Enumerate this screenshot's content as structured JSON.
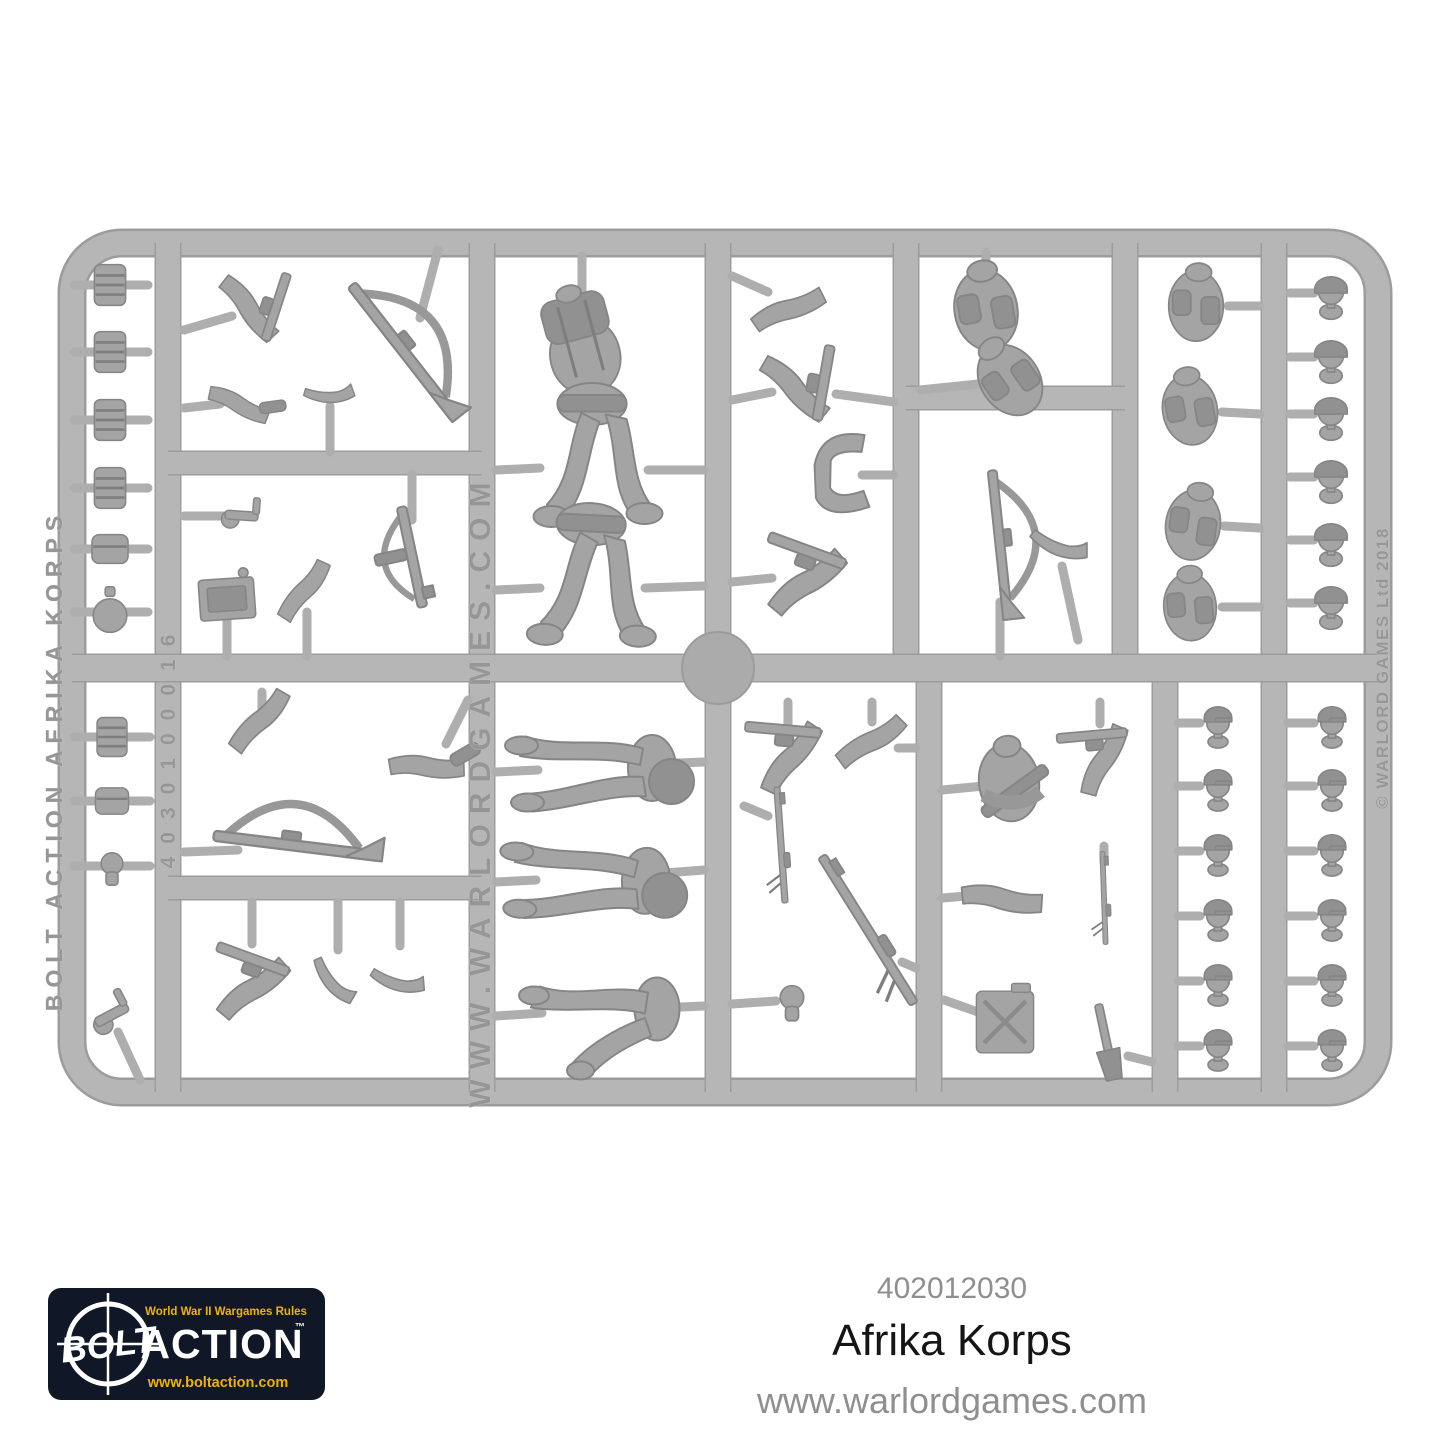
{
  "product": {
    "sku": "402012030",
    "name": "Afrika Korps",
    "website": "www.warlordgames.com"
  },
  "logo": {
    "tagline": "World War II Wargames Rules",
    "word_bolt": "BOLT",
    "word_action": "ACTION",
    "trademark": "™",
    "url": "www.boltaction.com",
    "bg_color": "#101827",
    "accent_color": "#f0b10d",
    "text_color": "#ffffff"
  },
  "sprue": {
    "plastic_color": "#b6b6b6",
    "edge_color": "#9c9c9c",
    "part_color": "#a4a4a4",
    "emboss_texts": {
      "left_rail": "BOLT ACTION AFRIKA KORPS",
      "mould_code": "4030100016",
      "center_rail": "WWW.WARLORDGAMES.COM",
      "right_rail": "© WARLORD GAMES Ltd 2018"
    },
    "parts": [
      {
        "k": "cyl",
        "x": 110,
        "y": 285,
        "s": 1.2,
        "stubs": [
          [
            74,
            285,
            148,
            285
          ]
        ]
      },
      {
        "k": "cyl",
        "x": 110,
        "y": 352,
        "s": 1.2,
        "stubs": [
          [
            74,
            352,
            148,
            352
          ]
        ]
      },
      {
        "k": "cyl",
        "x": 110,
        "y": 420,
        "s": 1.2,
        "stubs": [
          [
            74,
            420,
            148,
            420
          ]
        ]
      },
      {
        "k": "cyl",
        "x": 110,
        "y": 488,
        "s": 1.2,
        "stubs": [
          [
            74,
            488,
            148,
            488
          ]
        ]
      },
      {
        "k": "pouch",
        "x": 110,
        "y": 549,
        "s": 1.2,
        "stubs": [
          [
            74,
            549,
            148,
            549
          ]
        ]
      },
      {
        "k": "canteen",
        "x": 110,
        "y": 612,
        "s": 1.2,
        "stubs": [
          [
            74,
            612,
            148,
            612
          ]
        ]
      },
      {
        "k": "cyl",
        "x": 112,
        "y": 737,
        "s": 1.15,
        "stubs": [
          [
            74,
            737,
            150,
            737
          ]
        ]
      },
      {
        "k": "pouch",
        "x": 112,
        "y": 801,
        "s": 1.1,
        "stubs": [
          [
            74,
            801,
            150,
            801
          ]
        ]
      },
      {
        "k": "fist",
        "x": 112,
        "y": 866,
        "s": 1.2,
        "stubs": [
          [
            74,
            866,
            150,
            866
          ]
        ]
      },
      {
        "k": "pistolhand",
        "x": 117,
        "y": 1012,
        "r": -28,
        "s": 1.2,
        "stubs": [
          [
            118,
            1032,
            140,
            1080
          ]
        ]
      },
      {
        "k": "armgun",
        "x": 255,
        "y": 307,
        "r": 18,
        "s": 1.3,
        "stubs": [
          [
            184,
            330,
            232,
            316
          ]
        ]
      },
      {
        "k": "armtool",
        "x": 243,
        "y": 401,
        "r": -8,
        "s": 1.1,
        "stubs": [
          [
            184,
            408,
            220,
            404
          ]
        ]
      },
      {
        "k": "boot",
        "x": 330,
        "y": 389,
        "r": -35,
        "s": 1.1,
        "stubs": [
          [
            330,
            406,
            330,
            452
          ]
        ]
      },
      {
        "k": "riflesling",
        "x": 404,
        "y": 352,
        "r": 52,
        "s": 1.7,
        "stubs": [
          [
            438,
            250,
            420,
            318
          ]
        ]
      },
      {
        "k": "pistolhand",
        "x": 247,
        "y": 516,
        "r": 4,
        "s": 1.1,
        "stubs": [
          [
            184,
            516,
            226,
            516
          ]
        ]
      },
      {
        "k": "plate",
        "x": 227,
        "y": 599,
        "r": -4,
        "s": 1.2,
        "stubs": [
          [
            227,
            618,
            227,
            656
          ]
        ]
      },
      {
        "k": "arm",
        "x": 307,
        "y": 596,
        "r": 95,
        "s": 1.2,
        "stubs": [
          [
            307,
            612,
            307,
            656
          ]
        ]
      },
      {
        "k": "smg",
        "x": 412,
        "y": 557,
        "r": 78,
        "s": 1.6,
        "stubs": [
          [
            412,
            474,
            412,
            520
          ]
        ]
      },
      {
        "k": "torsopack",
        "x": 582,
        "y": 344,
        "r": -15,
        "s": 1.4,
        "stubs": [
          [
            582,
            256,
            582,
            300
          ]
        ]
      },
      {
        "k": "legsrun",
        "x": 592,
        "y": 464,
        "r": 0,
        "s": 1.5,
        "stubs": [
          [
            496,
            470,
            540,
            468
          ],
          [
            648,
            470,
            704,
            470
          ]
        ]
      },
      {
        "k": "legsrun",
        "x": 588,
        "y": 584,
        "r": 3,
        "s": 1.5,
        "stubs": [
          [
            496,
            590,
            540,
            588
          ],
          [
            645,
            588,
            704,
            586
          ]
        ]
      },
      {
        "k": "arm",
        "x": 789,
        "y": 303,
        "r": -55,
        "s": 1.3,
        "stubs": [
          [
            732,
            276,
            768,
            292
          ]
        ]
      },
      {
        "k": "armgun",
        "x": 801,
        "y": 386,
        "r": 10,
        "s": 1.4,
        "stubs": [
          [
            732,
            400,
            772,
            392
          ],
          [
            836,
            394,
            894,
            402
          ]
        ]
      },
      {
        "k": "armpair",
        "x": 838,
        "y": 475,
        "r": 85,
        "s": 1.5,
        "stubs": [
          [
            862,
            475,
            894,
            475
          ]
        ]
      },
      {
        "k": "armgun",
        "x": 806,
        "y": 575,
        "r": -70,
        "s": 1.5,
        "stubs": [
          [
            732,
            582,
            772,
            578
          ]
        ]
      },
      {
        "k": "torsogear",
        "x": 986,
        "y": 310,
        "r": -10,
        "s": 1.5,
        "stubs": [
          [
            986,
            252,
            986,
            280
          ]
        ]
      },
      {
        "k": "torsogear",
        "x": 1010,
        "y": 380,
        "r": -35,
        "s": 1.4,
        "stubs": [
          [
            920,
            390,
            978,
            384
          ]
        ]
      },
      {
        "k": "riflesling",
        "x": 1000,
        "y": 545,
        "r": 84,
        "s": 1.5,
        "stubs": [
          [
            1000,
            602,
            1000,
            656
          ]
        ]
      },
      {
        "k": "boot",
        "x": 1062,
        "y": 540,
        "r": -15,
        "s": 1.3,
        "stubs": [
          [
            1062,
            566,
            1078,
            640
          ]
        ]
      },
      {
        "k": "torsogear",
        "x": 1196,
        "y": 306,
        "r": 0,
        "s": 1.3,
        "stubs": [
          [
            1228,
            306,
            1260,
            306
          ]
        ]
      },
      {
        "k": "torsogear",
        "x": 1190,
        "y": 410,
        "r": -10,
        "s": 1.3,
        "stubs": [
          [
            1222,
            412,
            1260,
            414
          ]
        ]
      },
      {
        "k": "torsogear",
        "x": 1193,
        "y": 525,
        "r": 8,
        "s": 1.3,
        "stubs": [
          [
            1224,
            526,
            1260,
            528
          ]
        ]
      },
      {
        "k": "torsogear",
        "x": 1190,
        "y": 607,
        "r": -5,
        "s": 1.25,
        "stubs": [
          [
            1222,
            607,
            1260,
            607
          ]
        ]
      },
      {
        "k": "head",
        "x": 1331,
        "y": 293,
        "s": 1.25,
        "stubs": [
          [
            1290,
            293,
            1314,
            293
          ]
        ]
      },
      {
        "k": "head",
        "x": 1331,
        "y": 357,
        "s": 1.25,
        "stubs": [
          [
            1290,
            357,
            1314,
            357
          ]
        ]
      },
      {
        "k": "head",
        "x": 1331,
        "y": 414,
        "s": 1.25,
        "stubs": [
          [
            1290,
            414,
            1314,
            414
          ]
        ]
      },
      {
        "k": "head",
        "x": 1331,
        "y": 477,
        "s": 1.25,
        "stubs": [
          [
            1290,
            477,
            1314,
            477
          ]
        ]
      },
      {
        "k": "head",
        "x": 1331,
        "y": 540,
        "s": 1.25,
        "stubs": [
          [
            1290,
            540,
            1314,
            540
          ]
        ]
      },
      {
        "k": "head",
        "x": 1331,
        "y": 603,
        "s": 1.25,
        "stubs": [
          [
            1290,
            603,
            1314,
            603
          ]
        ]
      },
      {
        "k": "arm",
        "x": 262,
        "y": 727,
        "r": 100,
        "s": 1.3,
        "stubs": [
          [
            262,
            692,
            262,
            712
          ]
        ]
      },
      {
        "k": "armtool",
        "x": 430,
        "y": 761,
        "r": -30,
        "s": 1.3,
        "stubs": [
          [
            446,
            744,
            468,
            700
          ]
        ]
      },
      {
        "k": "riflesling",
        "x": 298,
        "y": 846,
        "r": 7,
        "s": 1.7,
        "stubs": [
          [
            184,
            852,
            238,
            850
          ]
        ]
      },
      {
        "k": "armgun",
        "x": 252,
        "y": 982,
        "r": -70,
        "s": 1.4,
        "stubs": [
          [
            252,
            902,
            252,
            944
          ]
        ]
      },
      {
        "k": "boot",
        "x": 338,
        "y": 978,
        "r": 15,
        "s": 1.2,
        "stubs": [
          [
            338,
            902,
            338,
            950
          ]
        ]
      },
      {
        "k": "boot",
        "x": 400,
        "y": 976,
        "r": -20,
        "s": 1.2,
        "stubs": [
          [
            400,
            902,
            400,
            946
          ]
        ]
      },
      {
        "k": "legsmarch",
        "x": 598,
        "y": 768,
        "r": 0,
        "s": 1.5,
        "stubs": [
          [
            496,
            772,
            538,
            770
          ],
          [
            655,
            764,
            704,
            762
          ]
        ]
      },
      {
        "k": "legsmarch",
        "x": 592,
        "y": 878,
        "r": 3,
        "s": 1.5,
        "stubs": [
          [
            496,
            882,
            536,
            880
          ],
          [
            652,
            874,
            704,
            870
          ]
        ]
      },
      {
        "k": "legskneel",
        "x": 600,
        "y": 1012,
        "r": 0,
        "s": 1.5,
        "stubs": [
          [
            496,
            1016,
            542,
            1013
          ],
          [
            658,
            1008,
            704,
            1006
          ]
        ]
      },
      {
        "k": "armgun",
        "x": 788,
        "y": 752,
        "r": -85,
        "s": 1.4,
        "stubs": [
          [
            788,
            702,
            788,
            724
          ]
        ]
      },
      {
        "k": "arm",
        "x": 872,
        "y": 748,
        "r": 115,
        "s": 1.3,
        "stubs": [
          [
            872,
            702,
            872,
            722
          ],
          [
            898,
            748,
            916,
            748
          ]
        ]
      },
      {
        "k": "gun",
        "x": 781,
        "y": 845,
        "r": 86,
        "s": 1.0,
        "stubs": [
          [
            744,
            806,
            768,
            816
          ]
        ]
      },
      {
        "k": "gun",
        "x": 868,
        "y": 930,
        "r": 58,
        "s": 1.5,
        "stubs": [
          [
            902,
            962,
            916,
            968
          ]
        ]
      },
      {
        "k": "fist",
        "x": 792,
        "y": 1000,
        "s": 1.3,
        "stubs": [
          [
            732,
            1004,
            776,
            1001
          ]
        ]
      },
      {
        "k": "smgtorso",
        "x": 1012,
        "y": 782,
        "r": -8,
        "s": 1.5,
        "stubs": [
          [
            942,
            790,
            984,
            786
          ]
        ]
      },
      {
        "k": "arm",
        "x": 1006,
        "y": 893,
        "r": -25,
        "s": 1.4,
        "stubs": [
          [
            942,
            898,
            980,
            895
          ]
        ]
      },
      {
        "k": "jerry",
        "x": 1005,
        "y": 1022,
        "s": 1.1,
        "stubs": [
          [
            944,
            1000,
            978,
            1012
          ]
        ]
      },
      {
        "k": "armgun",
        "x": 1100,
        "y": 755,
        "r": -95,
        "s": 1.3,
        "stubs": [
          [
            1100,
            702,
            1100,
            724
          ]
        ]
      },
      {
        "k": "gun",
        "x": 1104,
        "y": 898,
        "r": 88,
        "s": 0.8,
        "stubs": [
          [
            1104,
            846,
            1104,
            862
          ]
        ]
      },
      {
        "k": "shovel",
        "x": 1106,
        "y": 1040,
        "r": -12,
        "s": 1.3,
        "stubs": [
          [
            1128,
            1056,
            1152,
            1062
          ]
        ]
      },
      {
        "k": "headcap",
        "x": 1218,
        "y": 723,
        "s": 1.25,
        "stubs": [
          [
            1178,
            723,
            1200,
            723
          ]
        ]
      },
      {
        "k": "headcap",
        "x": 1218,
        "y": 786,
        "s": 1.25,
        "stubs": [
          [
            1178,
            786,
            1200,
            786
          ]
        ]
      },
      {
        "k": "headcap",
        "x": 1218,
        "y": 851,
        "s": 1.25,
        "stubs": [
          [
            1178,
            851,
            1200,
            851
          ]
        ]
      },
      {
        "k": "headcap",
        "x": 1218,
        "y": 916,
        "s": 1.25,
        "stubs": [
          [
            1178,
            916,
            1200,
            916
          ]
        ]
      },
      {
        "k": "headcap",
        "x": 1218,
        "y": 981,
        "s": 1.25,
        "stubs": [
          [
            1178,
            981,
            1200,
            981
          ]
        ]
      },
      {
        "k": "headcap",
        "x": 1218,
        "y": 1046,
        "s": 1.25,
        "stubs": [
          [
            1178,
            1046,
            1200,
            1046
          ]
        ]
      },
      {
        "k": "headcap",
        "x": 1332,
        "y": 723,
        "s": 1.25,
        "stubs": [
          [
            1288,
            723,
            1314,
            723
          ]
        ]
      },
      {
        "k": "headcap",
        "x": 1332,
        "y": 786,
        "s": 1.25,
        "stubs": [
          [
            1288,
            786,
            1314,
            786
          ]
        ]
      },
      {
        "k": "headcap",
        "x": 1332,
        "y": 851,
        "s": 1.25,
        "stubs": [
          [
            1288,
            851,
            1314,
            851
          ]
        ]
      },
      {
        "k": "headcap",
        "x": 1332,
        "y": 916,
        "s": 1.25,
        "stubs": [
          [
            1288,
            916,
            1314,
            916
          ]
        ]
      },
      {
        "k": "headcap",
        "x": 1332,
        "y": 981,
        "s": 1.25,
        "stubs": [
          [
            1288,
            981,
            1314,
            981
          ]
        ]
      },
      {
        "k": "headcap",
        "x": 1332,
        "y": 1046,
        "s": 1.25,
        "stubs": [
          [
            1288,
            1046,
            1314,
            1046
          ]
        ]
      }
    ]
  }
}
